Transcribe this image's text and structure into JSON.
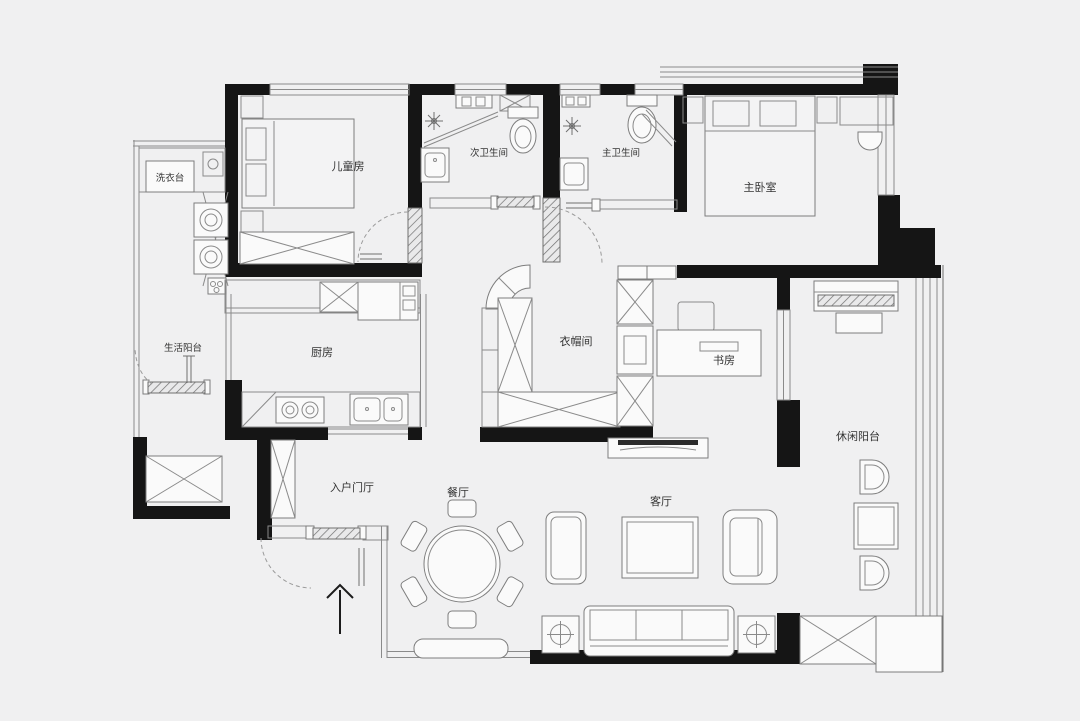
{
  "type": "floor-plan",
  "colors": {
    "background": "#f0f0f1",
    "wall": "#151515",
    "line": "#8a8a8a",
    "fixture_fill": "#fafafa"
  },
  "rooms": [
    {
      "id": "laundry-counter",
      "label": "洗衣台"
    },
    {
      "id": "children-room",
      "label": "儿童房"
    },
    {
      "id": "secondary-bathroom",
      "label": "次卫生间"
    },
    {
      "id": "master-bathroom",
      "label": "主卫生间"
    },
    {
      "id": "master-bedroom",
      "label": "主卧室"
    },
    {
      "id": "service-balcony",
      "label": "生活阳台"
    },
    {
      "id": "kitchen",
      "label": "厨房"
    },
    {
      "id": "cloakroom",
      "label": "衣帽间"
    },
    {
      "id": "study",
      "label": "书房"
    },
    {
      "id": "leisure-balcony",
      "label": "休闲阳台"
    },
    {
      "id": "entry-foyer",
      "label": "入户门厅"
    },
    {
      "id": "dining-room",
      "label": "餐厅"
    },
    {
      "id": "living-room",
      "label": "客厅"
    }
  ],
  "symbols": {
    "service_balcony": [
      "laundry-counter",
      "stacked-washer",
      "stacked-washer",
      "utility-sink",
      "sliding-door",
      "storage-cabinet"
    ],
    "children_room": [
      "bed",
      "nightstand",
      "nightstand",
      "wardrobe",
      "swing-door"
    ],
    "secondary_bathroom": [
      "toilet",
      "washbasin",
      "shower-head",
      "glass-screen",
      "duct-shaft"
    ],
    "master_bathroom": [
      "toilet",
      "washbasin",
      "shower-head",
      "glass-screen",
      "swing-door"
    ],
    "master_bedroom": [
      "double-bed",
      "pillows",
      "nightstand",
      "nightstand",
      "dressing-desk",
      "chair",
      "bay-window"
    ],
    "kitchen": [
      "upper-cabinets",
      "fridge",
      "tall-cabinet",
      "two-burner-stove",
      "double-sink",
      "corner-unit"
    ],
    "cloakroom": [
      "curved-corner-cabinet",
      "tall-wardrobe",
      "low-cabinet-row",
      "cabinet-column"
    ],
    "study": [
      "desk",
      "monitor",
      "chair"
    ],
    "leisure_balcony": [
      "piano",
      "piano-bench",
      "lounge-chair",
      "lounge-chair",
      "tea-table",
      "storage-cabinet",
      "window-wall"
    ],
    "entry_foyer": [
      "shoe-cabinet",
      "entry-door",
      "entry-direction-arrow"
    ],
    "dining_room": [
      "round-table",
      "chair-x6",
      "bench",
      "sideboard"
    ],
    "living_room": [
      "tv-cabinet",
      "tv",
      "coffee-table",
      "armchair",
      "three-seat-sofa",
      "lamp-side-table",
      "lamp-side-table"
    ]
  }
}
